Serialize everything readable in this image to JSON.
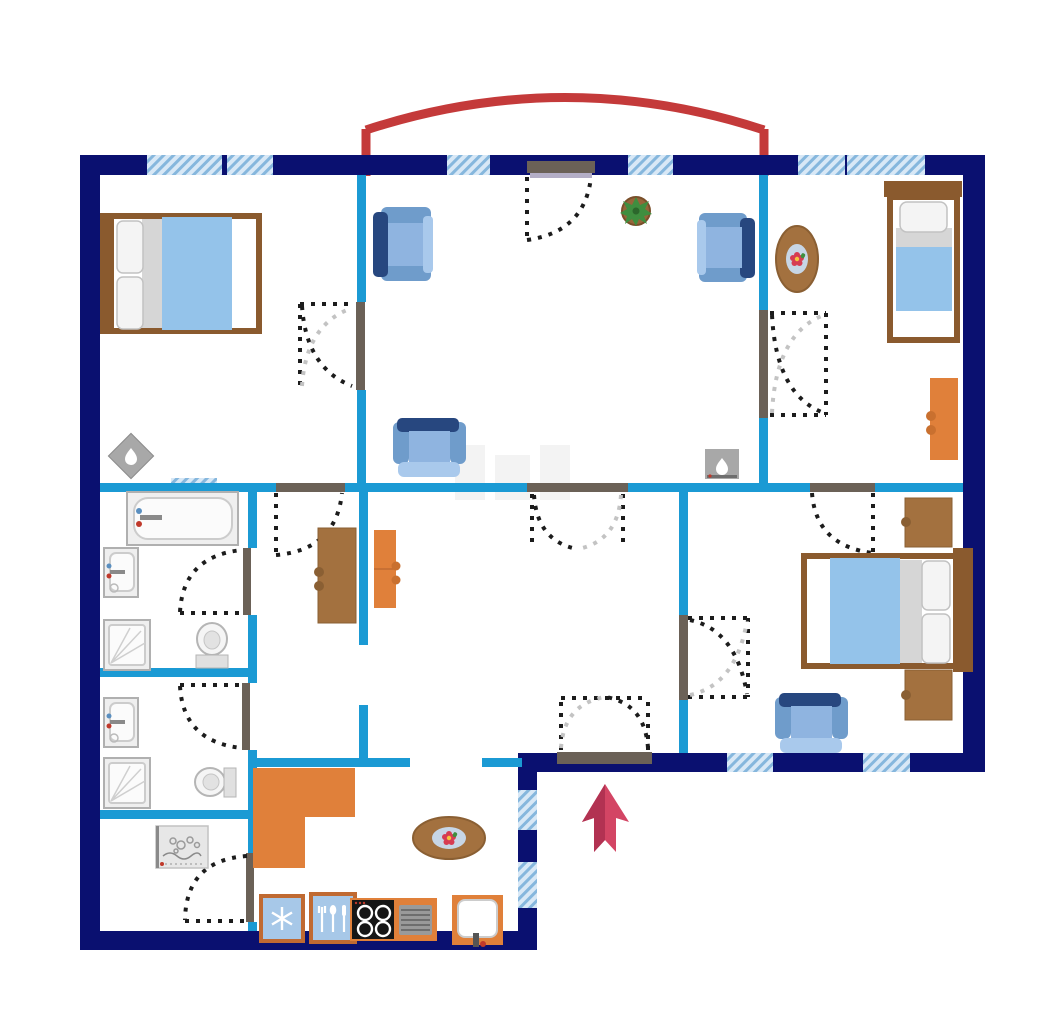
{
  "title": "apartment-floor-plan",
  "palette": {
    "navy": "#0a1070",
    "cyan": "#1b9ad4",
    "windowFill": "#d8e8f6",
    "windowStripe": "#86b7dd",
    "wallRed": "#c43a3a",
    "arrowMain": "#d34564",
    "arrowShade": "#b23252",
    "orange": "#e0803a",
    "brown": "#a3713f",
    "woodDark": "#8a5a2e",
    "blanket": "#94c3ea",
    "chairDark": "#27477f",
    "chairMid": "#6f9ccb",
    "chairSeat": "#8fb4e0",
    "chairLight": "#a9c9ec",
    "fixtureFill": "#efefef",
    "fixtureStroke": "#b0b0b0",
    "threshold": "#6b6157",
    "thresholdLight": "#b4aec6",
    "swingDark": "#1c1c1c",
    "swingLight": "#c3c3c3",
    "applianceBlue": "#a7c8e8",
    "applianceBorder": "#c06a32",
    "stoveBlack": "#161616",
    "grayIcon": "#a8a8a8",
    "potBrown": "#96653a",
    "leafGreen": "#3f8e3f",
    "flowerRed": "#d63c52",
    "tableInner": "#c7d6e6"
  },
  "icons": [
    "flame-icon",
    "snowflake-icon",
    "cutlery-icon",
    "plant-icon",
    "flower-icon",
    "entrance-arrow-icon",
    "bubbles-icon",
    "window-hatch"
  ],
  "legend": {
    "balcony_arc": "red arc over living room windows",
    "entrance_marker": "red arrow pointing at entrance door"
  },
  "rooms": [
    {
      "name": "bedroom-top-left",
      "furniture": [
        "double-bed",
        "fireplace"
      ]
    },
    {
      "name": "living-room",
      "furniture": [
        "armchair",
        "armchair",
        "armchair",
        "potted-plant",
        "fireplace"
      ]
    },
    {
      "name": "bedroom-top-right",
      "furniture": [
        "single-bed",
        "oval-table",
        "desk"
      ]
    },
    {
      "name": "bathroom",
      "furniture": [
        "bathtub",
        "sink",
        "shower",
        "toilet"
      ]
    },
    {
      "name": "wc",
      "furniture": [
        "sink",
        "shower",
        "toilet"
      ]
    },
    {
      "name": "laundry",
      "furniture": [
        "washing-machine"
      ]
    },
    {
      "name": "closet",
      "furniture": [
        "desk",
        "cabinet"
      ]
    },
    {
      "name": "kitchen",
      "furniture": [
        "counter",
        "oval-table",
        "fridge",
        "utensil-cabinet",
        "stove",
        "grill",
        "sink-unit"
      ]
    },
    {
      "name": "bedroom-bottom-right",
      "furniture": [
        "double-bed",
        "nightstand",
        "nightstand",
        "armchair"
      ]
    },
    {
      "name": "hallway",
      "furniture": []
    }
  ]
}
